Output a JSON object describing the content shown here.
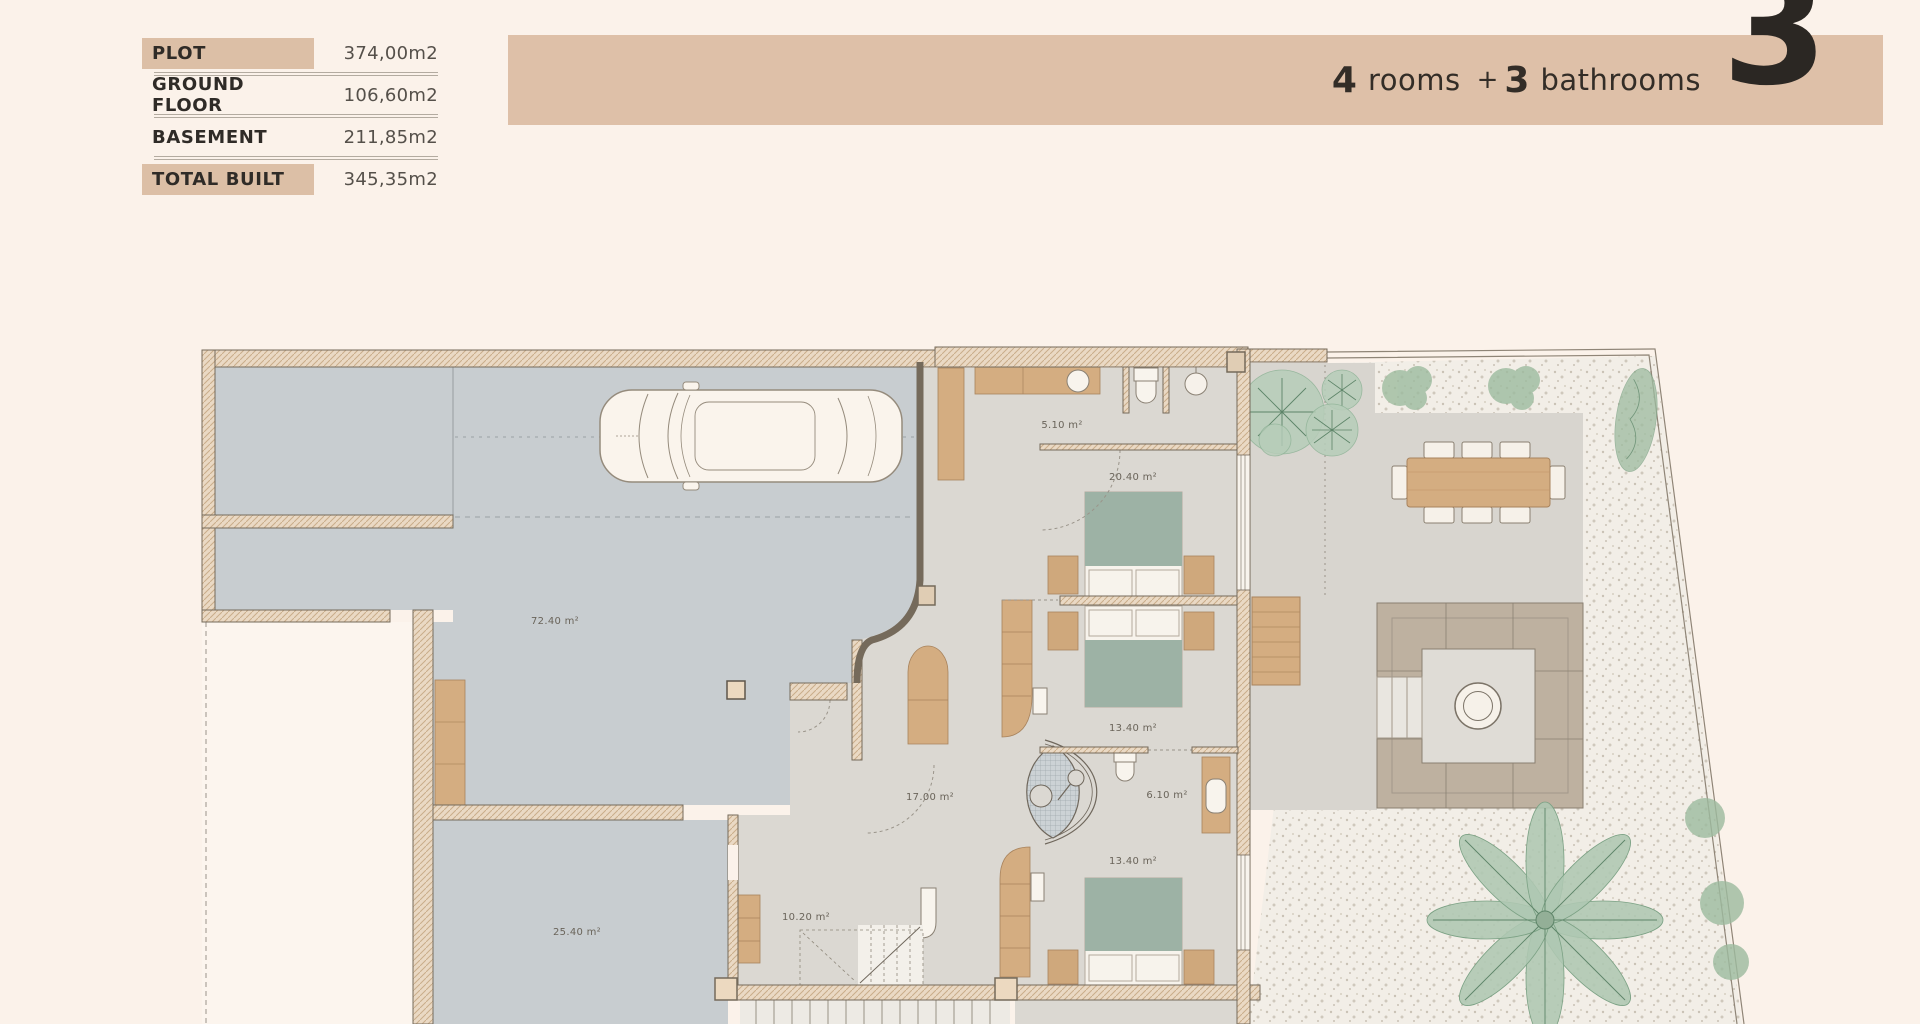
{
  "page": {
    "background": "#fbf2ea",
    "accent": "#dec0a8",
    "floor_gray": "#c8cdd0",
    "interior_floor": "#dbd8d2",
    "wood": "#d4ad81",
    "bed_green": "#9db2a5"
  },
  "stats_table": {
    "rows": [
      {
        "label": "PLOT",
        "value": "374,00m2",
        "highlighted": true
      },
      {
        "label": "GROUND FLOOR",
        "value": "106,60m2",
        "highlighted": false
      },
      {
        "label": "BASEMENT",
        "value": "211,85m2",
        "highlighted": false
      },
      {
        "label": "TOTAL BUILT",
        "value": "345,35m2",
        "highlighted": true
      }
    ]
  },
  "banner": {
    "rooms_count": "4",
    "rooms_label": "rooms",
    "plus": "+",
    "bathrooms_count": "3",
    "bathrooms_label": "bathrooms",
    "floor_number": "3"
  },
  "floor_plan": {
    "areas": {
      "garage": "72.40 m²",
      "entry": "5.10 m²",
      "bedroom1": "20.40 m²",
      "bedroom2": "13.40 m²",
      "hall": "17.00 m²",
      "bathroom": "6.10 m²",
      "bedroom3": "13.40 m²",
      "stairs": "10.20 m²",
      "storage": "25.40 m²"
    }
  }
}
